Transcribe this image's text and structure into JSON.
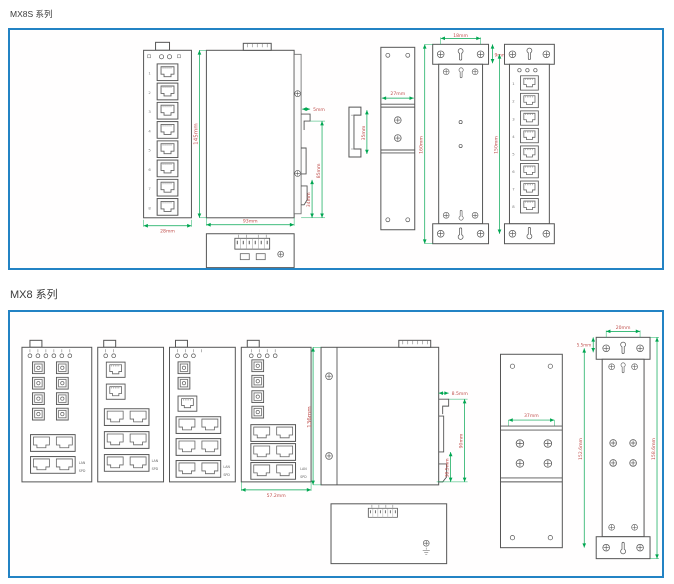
{
  "titles": {
    "section1": "MX8S 系列",
    "section2": "MX8 系列"
  },
  "colors": {
    "panel_border": "#2383c4",
    "dimension_line": "#00a651",
    "dimension_text": "#c0504d",
    "drawing_line": "#555555",
    "background": "#ffffff"
  },
  "panel1": {
    "series": "MX8S",
    "port_labels": [
      "1",
      "2",
      "3",
      "4",
      "5",
      "6",
      "7",
      "8"
    ],
    "dims": {
      "front_width": "28mm",
      "height": "145mm",
      "depth": "93mm",
      "clip_depth": "5mm",
      "clip_height": "85mm",
      "clip_lower": "34mm",
      "clip_profile_height": "35mm",
      "din_plate_width": "27mm",
      "mount_hole_spacing": "18mm",
      "mount_hole_offset": "9mm",
      "mount_height_outer": "160mm",
      "mount_height_inner": "150mm"
    }
  },
  "panel2": {
    "series": "MX8",
    "port_side_labels": {
      "lan": "LAN",
      "spd": "SPD"
    },
    "dims": {
      "front_width": "57.2mm",
      "height": "136mm",
      "clip_depth": "8.5mm",
      "clip_height": "90mm",
      "clip_lower": "38.5mm",
      "din_plate_width": "37mm",
      "mount_hole_spacing": "20mm",
      "mount_hole_offset": "5.5mm",
      "mount_height_inner": "152.6mm",
      "mount_height_outer": "158.6mm"
    }
  }
}
